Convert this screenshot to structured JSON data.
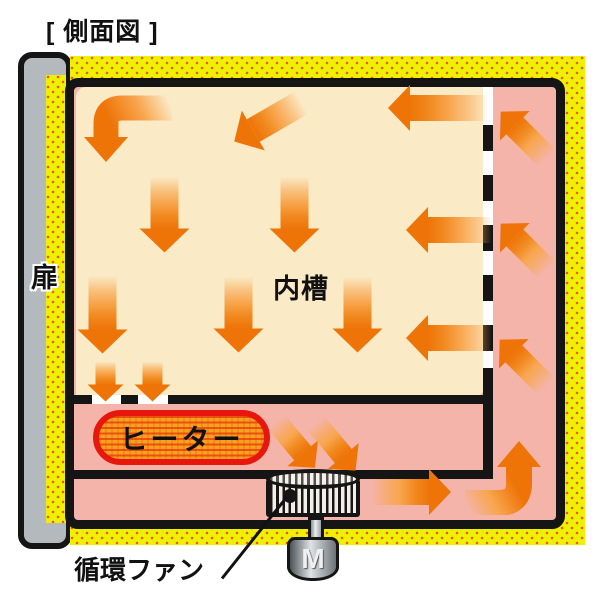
{
  "title": "[ 側面図 ]",
  "labels": {
    "door": "扉",
    "inner_chamber": "内槽",
    "heater": "ヒーター",
    "circulation_fan": "循環ファン",
    "motor": "M"
  },
  "colors": {
    "yellow": "#eef104",
    "dot": "#f0590a",
    "cream": "#faeac6",
    "pink": "#f4b4aa",
    "arrow": "#ee7408",
    "arrow_light": "#f8a64e",
    "heater_fill": "#f6a21d",
    "heater_border": "#e8170d",
    "frame": "#151515",
    "door_gray": "#b4b9bd",
    "white": "#ffffff"
  },
  "airflow_arrows": [
    {
      "direction": "down-left",
      "cx": 268,
      "cy": 122,
      "len": 78,
      "w": 26,
      "angle": 150
    },
    {
      "direction": "left",
      "cx": 438,
      "cy": 108,
      "len": 100,
      "w": 26,
      "angle": 180
    },
    {
      "direction": "down",
      "cx": 165,
      "cy": 214,
      "len": 76,
      "w": 28,
      "angle": 90
    },
    {
      "direction": "down",
      "cx": 295,
      "cy": 214,
      "len": 76,
      "w": 28,
      "angle": 90
    },
    {
      "direction": "left",
      "cx": 449,
      "cy": 230,
      "len": 86,
      "w": 26,
      "angle": 180
    },
    {
      "direction": "down",
      "cx": 103,
      "cy": 314,
      "len": 78,
      "w": 28,
      "angle": 90
    },
    {
      "direction": "down",
      "cx": 239,
      "cy": 314,
      "len": 76,
      "w": 28,
      "angle": 90
    },
    {
      "direction": "down",
      "cx": 358,
      "cy": 314,
      "len": 76,
      "w": 28,
      "angle": 90
    },
    {
      "direction": "left",
      "cx": 449,
      "cy": 338,
      "len": 86,
      "w": 26,
      "angle": 180
    },
    {
      "direction": "down",
      "cx": 106,
      "cy": 381,
      "len": 40,
      "w": 20,
      "angle": 90
    },
    {
      "direction": "down",
      "cx": 153,
      "cy": 381,
      "len": 40,
      "w": 20,
      "angle": 90
    },
    {
      "direction": "up-left",
      "cx": 524,
      "cy": 135,
      "len": 66,
      "w": 24,
      "angle": 225
    },
    {
      "direction": "up-left",
      "cx": 524,
      "cy": 247,
      "len": 66,
      "w": 24,
      "angle": 225
    },
    {
      "direction": "up-left",
      "cx": 523,
      "cy": 363,
      "len": 66,
      "w": 24,
      "angle": 225
    },
    {
      "direction": "down-right",
      "cx": 296,
      "cy": 444,
      "len": 60,
      "w": 22,
      "angle": 50
    },
    {
      "direction": "down-right",
      "cx": 336,
      "cy": 446,
      "len": 62,
      "w": 22,
      "angle": 50
    },
    {
      "direction": "right",
      "cx": 411,
      "cy": 492,
      "len": 80,
      "w": 26,
      "angle": 0
    }
  ]
}
